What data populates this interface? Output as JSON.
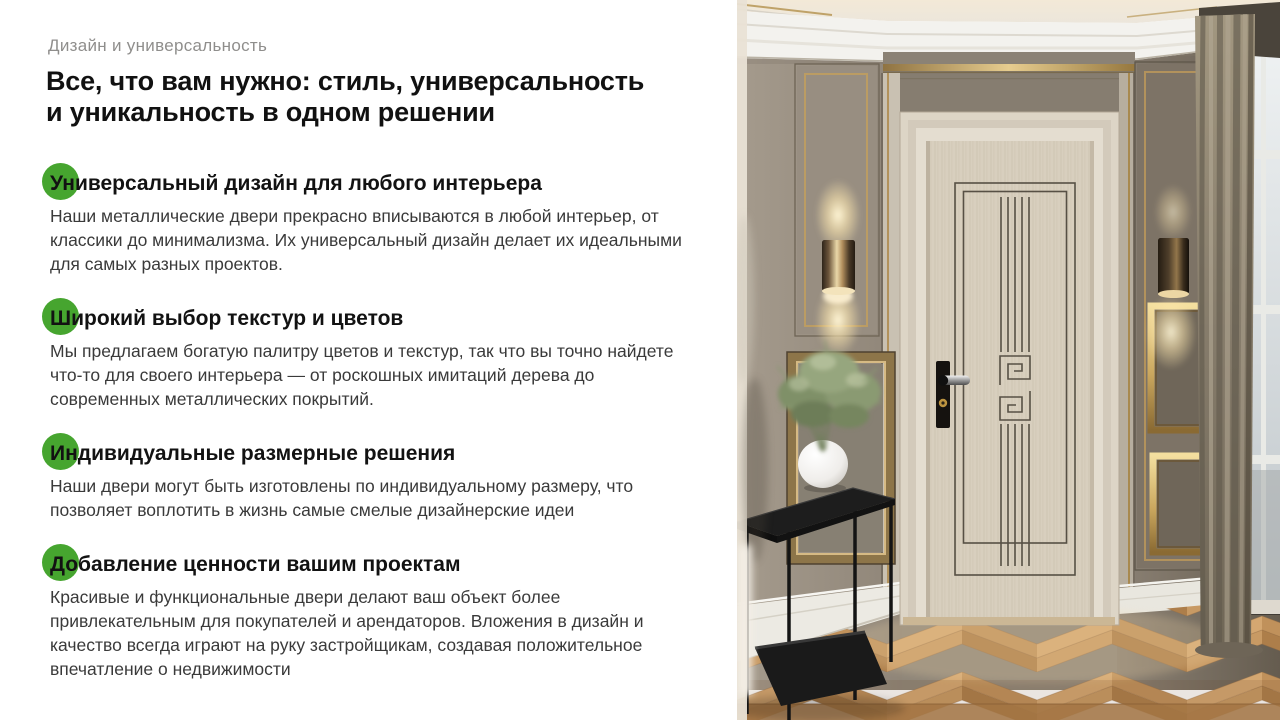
{
  "slide": {
    "eyebrow": "Дизайн и универсальность",
    "title_line1": "Все, что вам нужно: стиль, универсальность",
    "title_line2": "и уникальность в одном решении",
    "accent_color": "#46a52f",
    "sections": [
      {
        "title": "Универсальный дизайн для любого интерьера",
        "body": "Наши металлические двери прекрасно вписываются в любой интерьер, от классики до минимализма. Их универсальный дизайн делает их идеальными для самых разных проектов."
      },
      {
        "title": "Широкий выбор текстур и цветов",
        "body": "Мы предлагаем богатую палитру цветов и текстур, так что вы точно найдете что-то для своего интерьера — от роскошных имитаций дерева до современных металлических покрытий."
      },
      {
        "title": "Индивидуальные размерные решения",
        "body": "Наши двери могут быть изготовлены по индивидуальному размеру, что позволяет воплотить в жизнь самые смелые дизайнерские идеи"
      },
      {
        "title": "Добавление ценности вашим проектам",
        "body": "Красивые и функциональные двери делают ваш объект более привлекательным для покупателей и арендаторов. Вложения в дизайн и качество всегда играют на руку застройщикам, создавая положительное впечатление о недвижимости"
      }
    ]
  }
}
